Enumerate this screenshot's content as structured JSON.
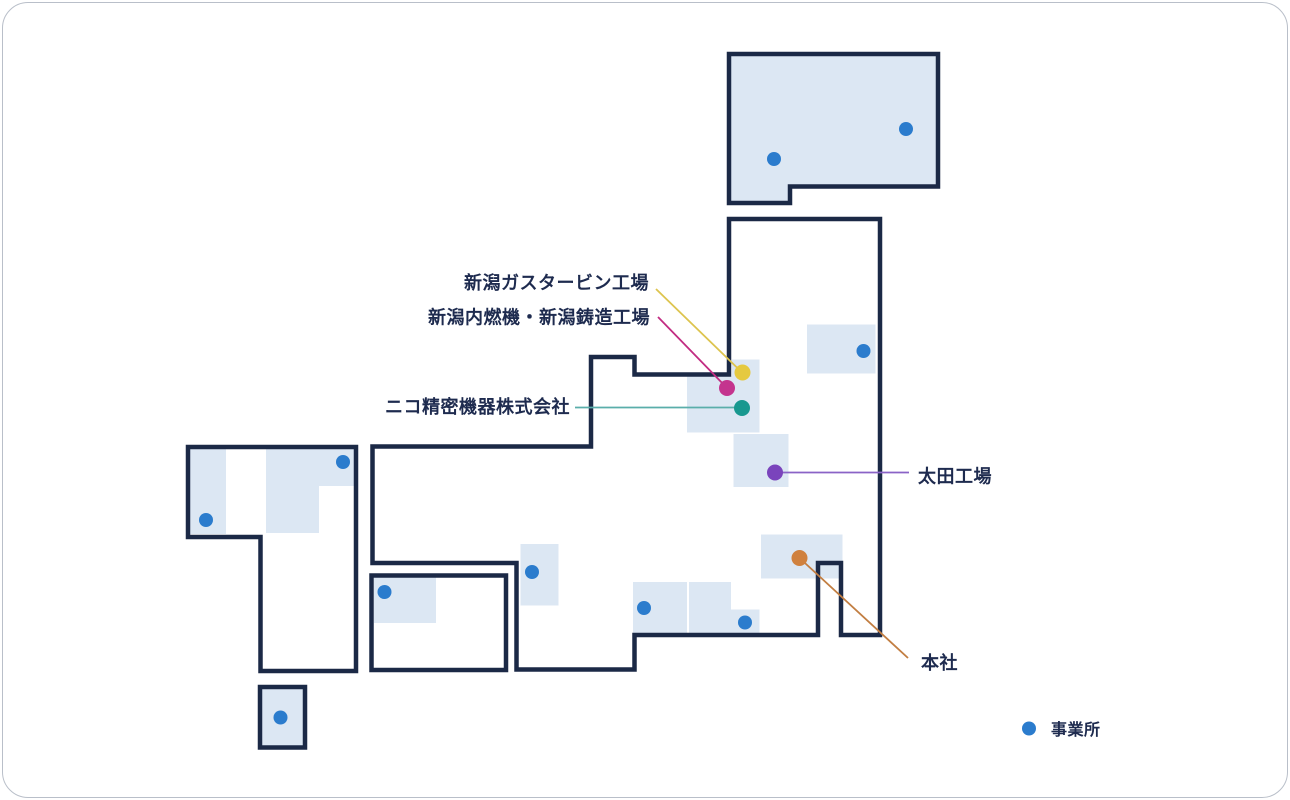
{
  "legend": {
    "label": "事業所",
    "dot_color": "#2b7ccd"
  },
  "colors": {
    "outline_navy": "#1b2946",
    "region_fill": "#dce7f3",
    "label_text": "#1e2b4f",
    "card_border": "#b9bfc9"
  },
  "map": {
    "named_sites": [
      {
        "id": "niigata-gas-turbine-plant",
        "label": "新潟ガスタービン工場",
        "color": "#e5c93f",
        "x": 741.5,
        "y": 371.5
      },
      {
        "id": "niigata-engine-casting-plant",
        "label": "新潟内燃機・新潟鋳造工場",
        "color": "#c4348e",
        "x": 726,
        "y": 387
      },
      {
        "id": "niko-precision",
        "label": "ニコ精密機器株式会社",
        "color": "#18988f",
        "x": 741,
        "y": 407
      },
      {
        "id": "ota-plant",
        "label": "太田工場",
        "color": "#7a44bc",
        "x": 774,
        "y": 471.5
      },
      {
        "id": "head-office",
        "label": "本社",
        "color": "#d0813e",
        "x": 798.5,
        "y": 557
      }
    ],
    "leader_lines": [
      {
        "name": "niigata-gas-turbine-plant",
        "x1": 655,
        "y1": 288,
        "x2": 739,
        "y2": 369.5,
        "color": "#ddc44e"
      },
      {
        "name": "niigata-engine-casting-plant",
        "x1": 657,
        "y1": 316,
        "x2": 726,
        "y2": 387,
        "color": "#c22c82"
      },
      {
        "name": "niko-precision",
        "x1": 574,
        "y1": 406.5,
        "x2": 741,
        "y2": 406.5,
        "color": "#5aaeaa"
      },
      {
        "name": "ota-plant",
        "x1": 774,
        "y1": 471.5,
        "x2": 908,
        "y2": 471.5,
        "color": "#8a63c6"
      },
      {
        "name": "head-office",
        "x1": 798.5,
        "y1": 557,
        "x2": 907,
        "y2": 657,
        "color": "#c27e42"
      }
    ],
    "office_dots": [
      {
        "x": 905,
        "y": 128
      },
      {
        "x": 773,
        "y": 158
      },
      {
        "x": 862.5,
        "y": 350
      },
      {
        "x": 342,
        "y": 461
      },
      {
        "x": 205,
        "y": 519
      },
      {
        "x": 531,
        "y": 571
      },
      {
        "x": 383.5,
        "y": 591
      },
      {
        "x": 643,
        "y": 607
      },
      {
        "x": 744,
        "y": 621.5
      },
      {
        "x": 279.5,
        "y": 716.5
      }
    ]
  }
}
